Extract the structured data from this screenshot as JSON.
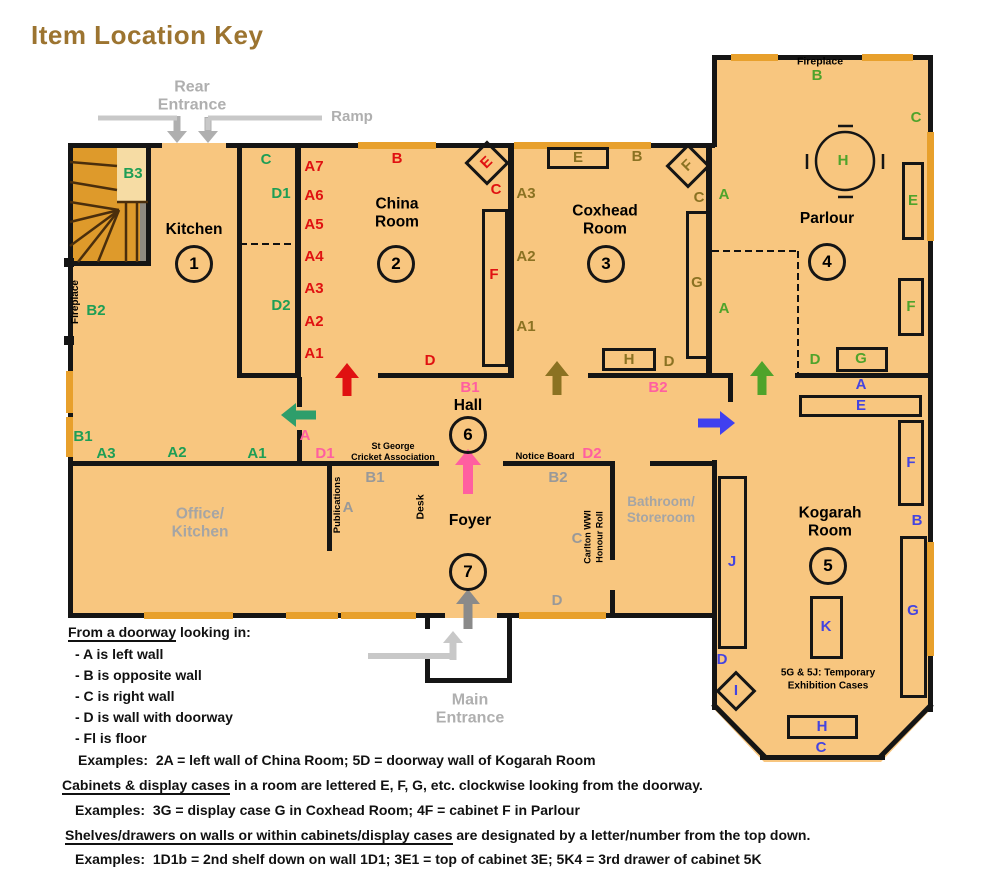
{
  "title": "Item Location Key",
  "colors": {
    "title_brown": "#9C7430",
    "room_fill": "#F8C67F",
    "window_orange": "#E8A02C",
    "wall_black": "#151515",
    "kitchen_green": "#1E9E55",
    "kitchen_arrow_green": "#2E9E6B",
    "china_red": "#E01111",
    "coxhead_olive": "#8B7222",
    "parlour_green": "#4FA32B",
    "kogarah_blue": "#4444E0",
    "kogarah_arrow_blue": "#4040F0",
    "hall_pink": "#FF5FA0",
    "foyer_gray": "#999999",
    "room_gray": "#A5A5A5",
    "entrance_gray": "#AFAFAF",
    "ramp_light": "#C8C8C8",
    "main_arrow_gray": "#8A8A8A",
    "stair_orange": "#DE9A2B",
    "stair_light": "#F6DCA4",
    "stair_gray": "#8F8A80",
    "tread_brown": "#4A2E0C"
  },
  "entrances": {
    "rear": "Rear\nEntrance",
    "ramp": "Ramp",
    "main": "Main\nEntrance"
  },
  "rooms": [
    {
      "id": "kitchen",
      "name": "Kitchen",
      "name_xy": [
        194,
        230
      ],
      "number": "1",
      "num_xy": [
        194,
        264
      ],
      "color": "kitchen_green",
      "labels": [
        {
          "t": "B3",
          "x": 133,
          "y": 174
        },
        {
          "t": "C",
          "x": 266,
          "y": 160
        },
        {
          "t": "D1",
          "x": 281,
          "y": 194
        },
        {
          "t": "D2",
          "x": 281,
          "y": 306
        },
        {
          "t": "B2",
          "x": 96,
          "y": 311
        },
        {
          "t": "B1",
          "x": 83,
          "y": 437
        },
        {
          "t": "A3",
          "x": 106,
          "y": 454
        },
        {
          "t": "A2",
          "x": 177,
          "y": 453
        },
        {
          "t": "A1",
          "x": 257,
          "y": 454
        }
      ]
    },
    {
      "id": "china-room",
      "name": "China\nRoom",
      "name_xy": [
        397,
        214
      ],
      "number": "2",
      "num_xy": [
        396,
        264
      ],
      "color": "china_red",
      "labels": [
        {
          "t": "A7",
          "x": 314,
          "y": 167
        },
        {
          "t": "A6",
          "x": 314,
          "y": 196
        },
        {
          "t": "A5",
          "x": 314,
          "y": 225
        },
        {
          "t": "A4",
          "x": 314,
          "y": 257
        },
        {
          "t": "A3",
          "x": 314,
          "y": 289
        },
        {
          "t": "A2",
          "x": 314,
          "y": 322
        },
        {
          "t": "A1",
          "x": 314,
          "y": 354
        },
        {
          "t": "B",
          "x": 397,
          "y": 159
        },
        {
          "t": "E",
          "diamond": [
            487,
            163,
            26
          ],
          "rot": -45
        },
        {
          "t": "C",
          "x": 496,
          "y": 190
        },
        {
          "t": "F",
          "box": [
            482,
            209,
            26,
            158
          ],
          "x": 494,
          "y": 275
        },
        {
          "t": "D",
          "x": 430,
          "y": 361
        }
      ]
    },
    {
      "id": "coxhead-room",
      "name": "Coxhead\nRoom",
      "name_xy": [
        605,
        221
      ],
      "number": "3",
      "num_xy": [
        606,
        264
      ],
      "color": "coxhead_olive",
      "labels": [
        {
          "t": "E",
          "box": [
            547,
            147,
            62,
            22
          ]
        },
        {
          "t": "B",
          "x": 637,
          "y": 157
        },
        {
          "t": "F",
          "diamond": [
            688,
            166,
            26
          ],
          "rot": -45
        },
        {
          "t": "C",
          "x": 699,
          "y": 198
        },
        {
          "t": "A3",
          "x": 526,
          "y": 194
        },
        {
          "t": "A2",
          "x": 526,
          "y": 257
        },
        {
          "t": "A1",
          "x": 526,
          "y": 327
        },
        {
          "t": "G",
          "box": [
            686,
            211,
            23,
            148
          ],
          "x": 697,
          "y": 283
        },
        {
          "t": "H",
          "box": [
            602,
            348,
            54,
            23
          ]
        },
        {
          "t": "D",
          "x": 669,
          "y": 362
        }
      ]
    },
    {
      "id": "parlour",
      "name": "Parlour",
      "name_xy": [
        827,
        219
      ],
      "number": "4",
      "num_xy": [
        827,
        262
      ],
      "color": "parlour_green",
      "labels": [
        {
          "t": "B",
          "x": 817,
          "y": 76
        },
        {
          "t": "C",
          "x": 916,
          "y": 118
        },
        {
          "t": "H",
          "x": 843,
          "y": 161
        },
        {
          "t": "E",
          "box": [
            902,
            162,
            22,
            78
          ],
          "x": 913,
          "y": 201
        },
        {
          "t": "A",
          "x": 724,
          "y": 195
        },
        {
          "t": "F",
          "box": [
            898,
            278,
            26,
            58
          ],
          "x": 911,
          "y": 307
        },
        {
          "t": "A",
          "x": 724,
          "y": 309
        },
        {
          "t": "D",
          "x": 815,
          "y": 360
        },
        {
          "t": "G",
          "box": [
            836,
            347,
            52,
            25
          ],
          "x": 861,
          "y": 359
        }
      ]
    },
    {
      "id": "kogarah-room",
      "name": "Kogarah\nRoom",
      "name_xy": [
        830,
        523
      ],
      "number": "5",
      "num_xy": [
        828,
        566
      ],
      "color": "kogarah_blue",
      "labels": [
        {
          "t": "A",
          "x": 861,
          "y": 385
        },
        {
          "t": "E",
          "box": [
            799,
            395,
            123,
            22
          ],
          "x": 861,
          "y": 406
        },
        {
          "t": "F",
          "box": [
            898,
            420,
            26,
            86
          ],
          "x": 911,
          "y": 463
        },
        {
          "t": "B",
          "x": 917,
          "y": 521
        },
        {
          "t": "G",
          "box": [
            900,
            536,
            27,
            162
          ],
          "x": 913,
          "y": 611
        },
        {
          "t": "J",
          "box": [
            718,
            476,
            29,
            173
          ],
          "x": 732,
          "y": 562
        },
        {
          "t": "K",
          "box": [
            810,
            596,
            33,
            63
          ],
          "x": 826,
          "y": 627
        },
        {
          "t": "D",
          "x": 722,
          "y": 660
        },
        {
          "t": "I",
          "diamond": [
            736,
            691,
            23
          ],
          "rot": 0
        },
        {
          "t": "H",
          "box": [
            787,
            715,
            71,
            24
          ],
          "x": 822,
          "y": 727
        },
        {
          "t": "C",
          "x": 821,
          "y": 748
        }
      ]
    },
    {
      "id": "hall",
      "name": "Hall",
      "name_xy": [
        468,
        406
      ],
      "number": "6",
      "num_xy": [
        468,
        435
      ],
      "color": "hall_pink",
      "labels": [
        {
          "t": "B1",
          "x": 470,
          "y": 388
        },
        {
          "t": "B2",
          "x": 658,
          "y": 388
        },
        {
          "t": "A",
          "x": 305,
          "y": 436
        },
        {
          "t": "D1",
          "x": 325,
          "y": 454
        },
        {
          "t": "D2",
          "x": 592,
          "y": 454
        }
      ]
    },
    {
      "id": "foyer",
      "name": "Foyer",
      "name_xy": [
        470,
        521
      ],
      "number": "7",
      "num_xy": [
        468,
        572
      ],
      "color": "foyer_gray",
      "labels": [
        {
          "t": "B1",
          "x": 375,
          "y": 478
        },
        {
          "t": "A",
          "x": 348,
          "y": 508
        },
        {
          "t": "B2",
          "x": 558,
          "y": 478
        },
        {
          "t": "C",
          "x": 577,
          "y": 539
        },
        {
          "t": "D",
          "x": 557,
          "y": 601
        }
      ]
    },
    {
      "id": "office-kitchen",
      "name": "Office/\nKitchen",
      "name_xy": [
        200,
        524
      ],
      "name_color": "room_gray"
    },
    {
      "id": "bathroom-storeroom",
      "name": "Bathroom/\nStoreroom",
      "name_xy": [
        661,
        510
      ],
      "name_color": "room_gray",
      "name_size": 13.5
    }
  ],
  "annotations": [
    {
      "t": "Fireplace",
      "x": 76,
      "y": 302,
      "vertical": true,
      "size": 10
    },
    {
      "t": "Fireplace",
      "x": 820,
      "y": 62,
      "size": 10.5
    },
    {
      "t": "St George\nCricket Association",
      "x": 393,
      "y": 452,
      "size": 9
    },
    {
      "t": "Notice Board",
      "x": 545,
      "y": 457,
      "size": 9.5
    },
    {
      "t": "Publications",
      "x": 338,
      "y": 505,
      "vertical": true,
      "size": 9.5
    },
    {
      "t": "Desk",
      "x": 421,
      "y": 507,
      "vertical": true,
      "size": 10.5
    },
    {
      "t": "Carlton WWI",
      "x": 588,
      "y": 537,
      "vertical": true,
      "size": 9
    },
    {
      "t": "Honour Roll",
      "x": 600,
      "y": 537,
      "vertical": true,
      "size": 9
    },
    {
      "t": "5G & 5J: Temporary\nExhibition Cases",
      "x": 828,
      "y": 680,
      "size": 10
    }
  ],
  "legend": {
    "lines": [
      {
        "x": 68,
        "y": 624,
        "u": "From a doorway",
        "t": " looking in:"
      },
      {
        "x": 75,
        "y": 646,
        "u": "",
        "t": "- A is left wall"
      },
      {
        "x": 75,
        "y": 667,
        "u": "",
        "t": "- B is opposite wall"
      },
      {
        "x": 75,
        "y": 688,
        "u": "",
        "t": "- C is right wall"
      },
      {
        "x": 75,
        "y": 709,
        "u": "",
        "t": "- D is wall with doorway"
      },
      {
        "x": 75,
        "y": 730,
        "u": "",
        "t": "- Fl is floor"
      },
      {
        "x": 78,
        "y": 752,
        "u": "",
        "t": "Examples:  2A = left wall of China Room; 5D = doorway wall of Kogarah Room"
      },
      {
        "x": 62,
        "y": 777,
        "u": "Cabinets & display cases",
        "t": " in a room are lettered E, F, G, etc. clockwise looking from the doorway."
      },
      {
        "x": 75,
        "y": 802,
        "u": "",
        "t": "Examples:  3G = display case G in Coxhead Room; 4F = cabinet F in Parlour"
      },
      {
        "x": 65,
        "y": 827,
        "u": "Shelves/drawers on walls or within cabinets/display cases",
        "t": " are designated by a letter/number from the top down."
      },
      {
        "x": 75,
        "y": 851,
        "u": "",
        "t": "Examples:  1D1b = 2nd shelf down on wall 1D1; 3E1 = top of cabinet 3E; 5K4 = 3rd drawer of cabinet 5K"
      }
    ]
  }
}
